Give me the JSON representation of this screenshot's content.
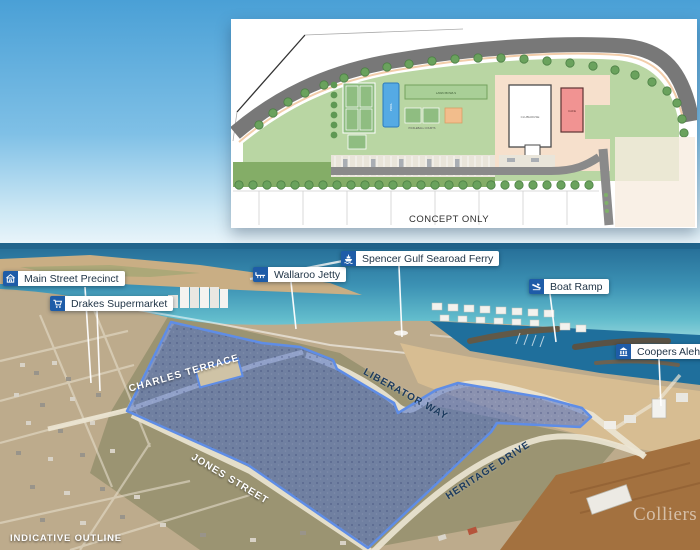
{
  "concept_plan": {
    "caption": "CONCEPT ONLY",
    "labels": {
      "lawn_bowls": "LAWN BOWLS",
      "pickleball": "PICKLEBALL COURTS",
      "pool": "POOL",
      "clubhouse": "CLUBHOUSE",
      "cafe": "CAFE"
    }
  },
  "callouts": [
    {
      "label": "Main Street Precinct",
      "icon": "storefront-icon"
    },
    {
      "label": "Drakes Supermarket",
      "icon": "cart-icon"
    },
    {
      "label": "Wallaroo Jetty",
      "icon": "jetty-icon"
    },
    {
      "label": "Spencer Gulf Searoad Ferry",
      "icon": "ferry-icon"
    },
    {
      "label": "Boat Ramp",
      "icon": "boat-ramp-icon"
    },
    {
      "label": "Coopers Alehouse",
      "icon": "alehouse-icon"
    }
  ],
  "streets": [
    {
      "name": "CHARLES TERRACE"
    },
    {
      "name": "JONES STREET"
    },
    {
      "name": "LIBERATOR WAY"
    },
    {
      "name": "HERITAGE DRIVE"
    }
  ],
  "footer": {
    "legend": "INDICATIVE OUTLINE",
    "watermark": "Colliers"
  },
  "colors": {
    "tag_blue": "#1e5ca8",
    "site_outline": "#5f8de6",
    "site_fill": "rgba(77,112,200,0.55)"
  }
}
